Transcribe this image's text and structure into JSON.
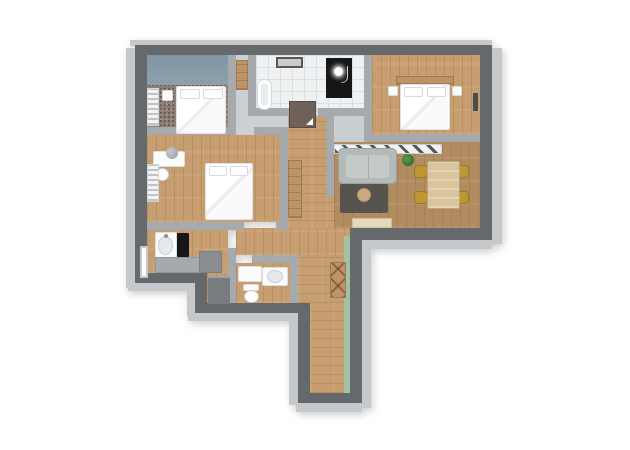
{
  "scene": {
    "type": "3d-floorplan-render",
    "description": "Top-down 3D render of an apartment floor plan on a white background",
    "visible_text": "none"
  },
  "colors": {
    "wall_dark": "#66696c",
    "wall_mid": "#a7aaad",
    "wall_light": "#c6c9cb",
    "accent_blue": "#8fa0ab",
    "accent_green": "#a3c2a4",
    "wood_light": "#c79e6f",
    "wood_mid": "#b08c60",
    "carpet": "#8d7f76",
    "tile": "#eff1f2",
    "sofa": "#b3bab7",
    "rug": "#57534f",
    "pouf": "#c9a980",
    "table": "#d9c49d",
    "chair": "#bd9733",
    "plant": "#37702f",
    "door": "#6f6058",
    "black": "#161616",
    "white_furniture": "#fbfbfb",
    "counter": "#a7aaac",
    "counter_dark": "#8b8e90",
    "fridge": "#797d80",
    "sideboard": "#e6dabb",
    "wood_cabinet": "#bd9468"
  },
  "rooms": [
    {
      "id": "bedroom-1",
      "label": "Bedroom top-left with carpet, double bed, nightstand, radiator and blue-gray accent wall"
    },
    {
      "id": "closet-niche",
      "label": "Storage niche with wooden shelf"
    },
    {
      "id": "bathroom",
      "label": "Bathroom with white tile floor, bathtub, wall mirror and black shower cabin"
    },
    {
      "id": "bedroom-2",
      "label": "Bedroom top-right with wood floor, double bed, wooden headboard and two nightstands"
    },
    {
      "id": "bedroom-3",
      "label": "Bedroom middle-left with desk, desk chair, double bed and radiator"
    },
    {
      "id": "hallway",
      "label": "Entrance hallway with dark entrance door and wardrobe"
    },
    {
      "id": "living-room",
      "label": "Living and dining room with sofa, rug, pouf, plant, dining table, four yellow chairs, sideboard and striped radiator strip"
    },
    {
      "id": "kitchen",
      "label": "Kitchen with sink unit, black cooktop, gray counters, fridge and window"
    },
    {
      "id": "wc",
      "label": "WC and laundry with washing machine, washbasin and toilet"
    },
    {
      "id": "corridor",
      "label": "Long bottom corridor with green accent wall and wooden cross cabinet"
    }
  ]
}
